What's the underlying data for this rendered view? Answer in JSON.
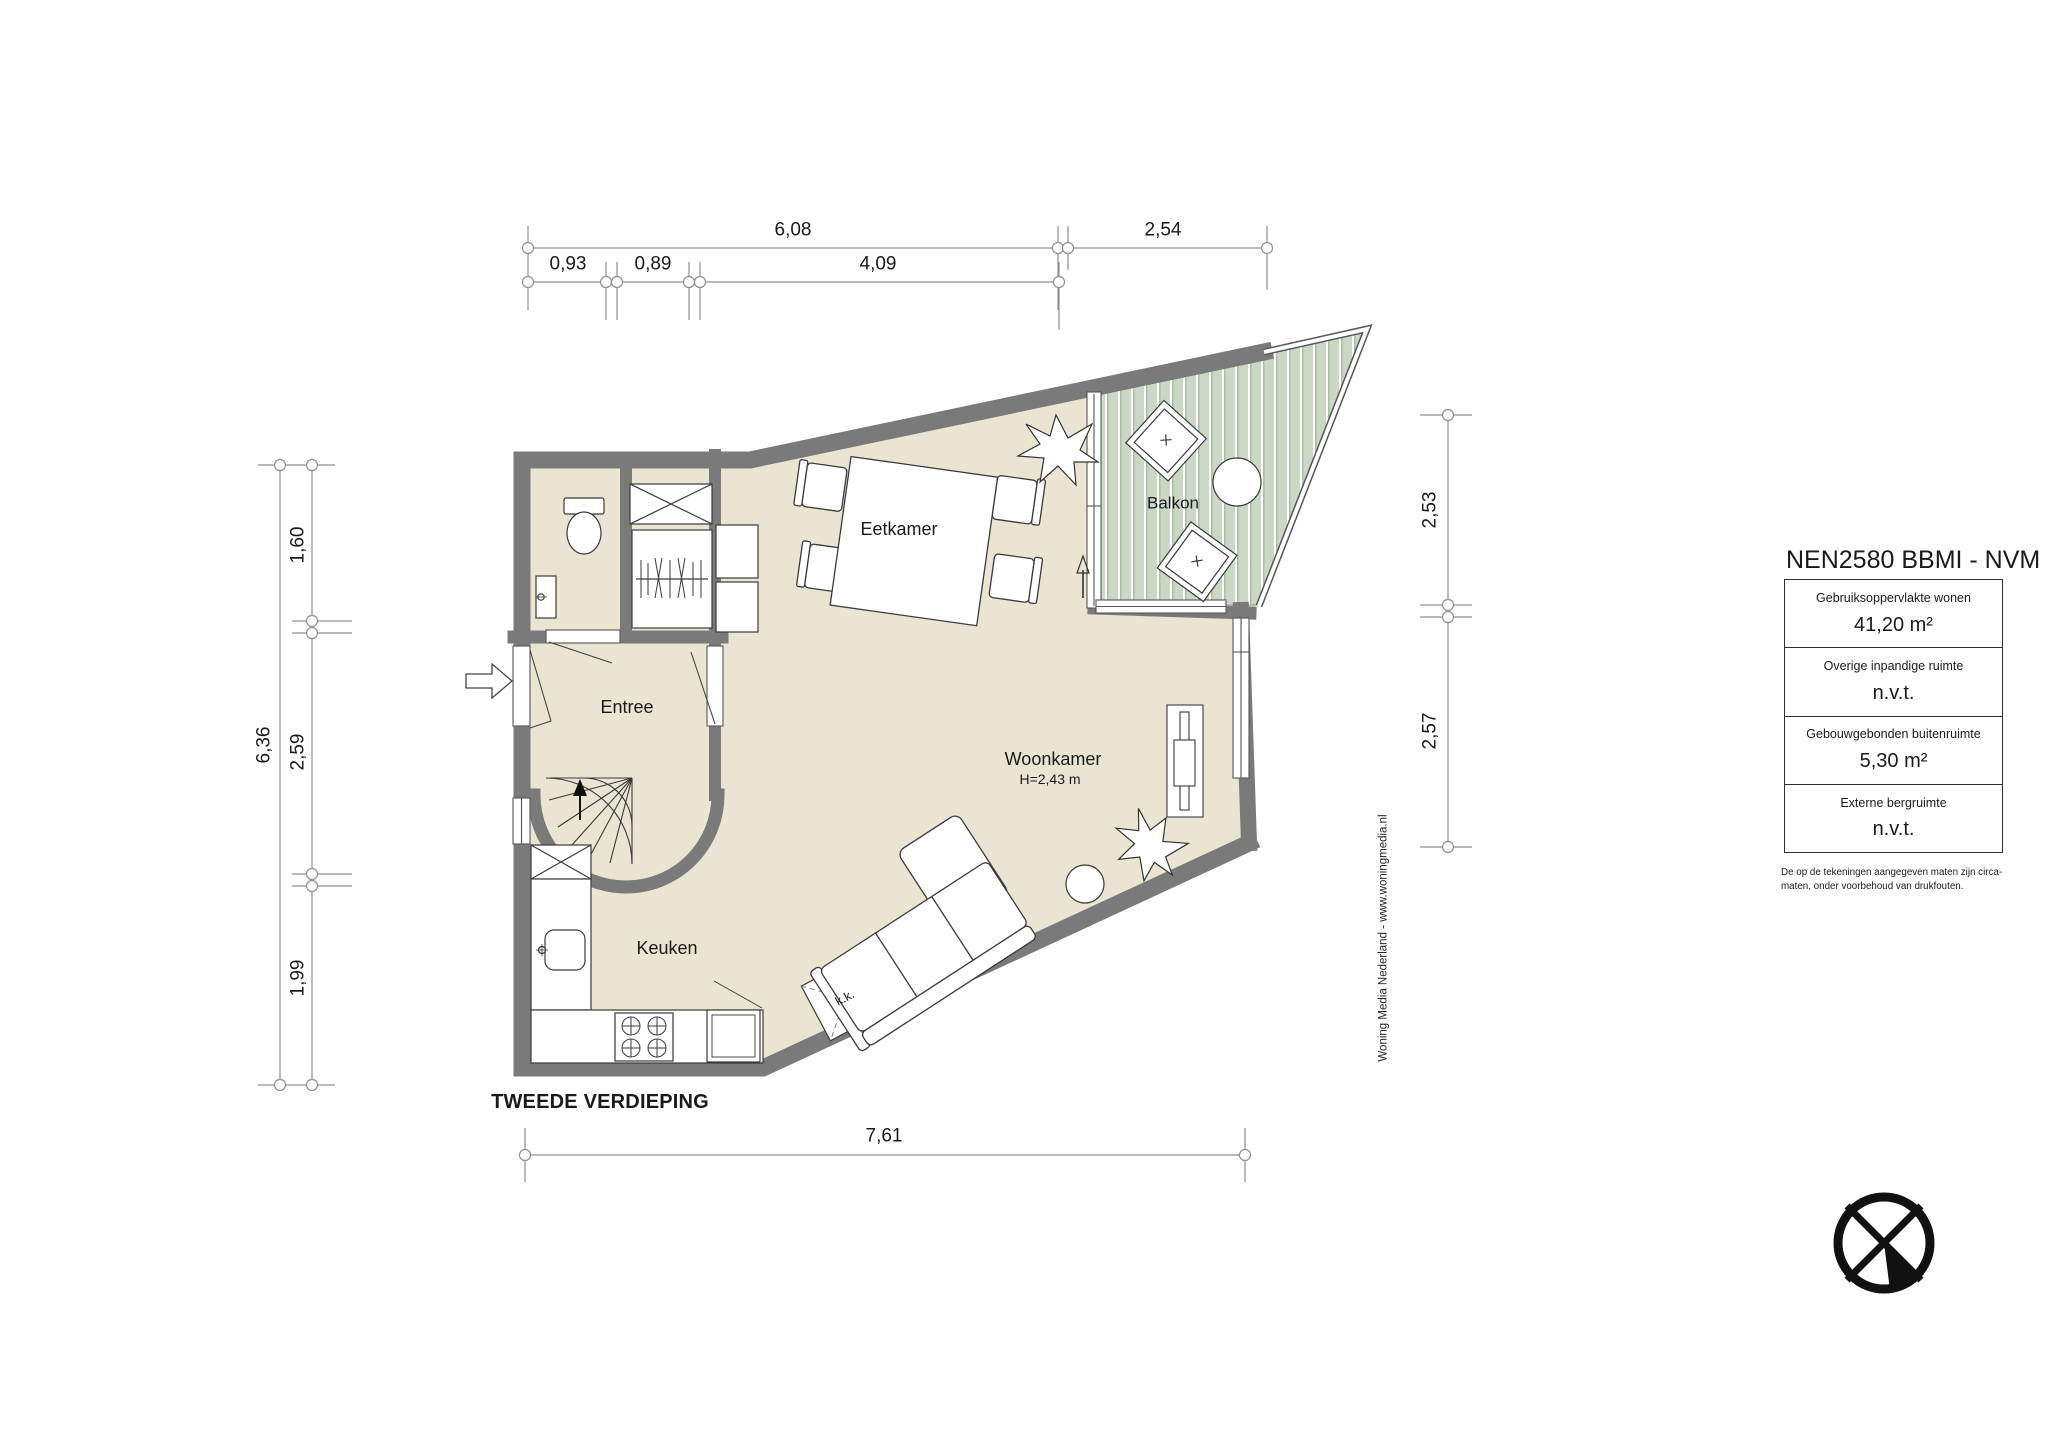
{
  "floor_title": "TWEEDE VERDIEPING",
  "rooms": {
    "entree": "Entree",
    "eetkamer": "Eetkamer",
    "balkon": "Balkon",
    "woonkamer": "Woonkamer",
    "woonkamer_height": "H=2,43 m",
    "keuken": "Keuken",
    "kitchenette": "k.k."
  },
  "dims": {
    "top_row1": [
      "6,08",
      "2,54"
    ],
    "top_row2": [
      "0,93",
      "0,89",
      "4,09"
    ],
    "left_total": "6,36",
    "left_col": [
      "1,60",
      "2,59",
      "1,99"
    ],
    "right_col": [
      "2,53",
      "2,57"
    ],
    "bottom": "7,61"
  },
  "info_panel": {
    "title": "NEN2580 BBMI - NVM",
    "rows": [
      {
        "label": "Gebruiksoppervlakte wonen",
        "value": "41,20 m²"
      },
      {
        "label": "Overige inpandige ruimte",
        "value": "n.v.t."
      },
      {
        "label": "Gebouwgebonden buitenruimte",
        "value": "5,30 m²"
      },
      {
        "label": "Externe bergruimte",
        "value": "n.v.t."
      }
    ],
    "footnote": "De op de tekeningen aangegeven maten zijn circa-maten, onder voorbehoud van drukfouten."
  },
  "watermark": "Woning Media Nederland - www.woningmedia.nl",
  "icons": {
    "compass": "north-direction-compass",
    "entrance_arrow": "entrance-direction-arrow",
    "stairs_arrow": "stairs-up-arrow",
    "balcony_door_arrow": "balcony-door-arrow"
  },
  "colors": {
    "floor": "#e9e5d2",
    "wall": "#7a7a7a",
    "balcony_plank": "#cbd8c5",
    "balcony_stripe": "#9fb69b",
    "outline": "#3a3a3a",
    "dimension_line": "#8f8f8f",
    "text": "#1a1a1a"
  }
}
